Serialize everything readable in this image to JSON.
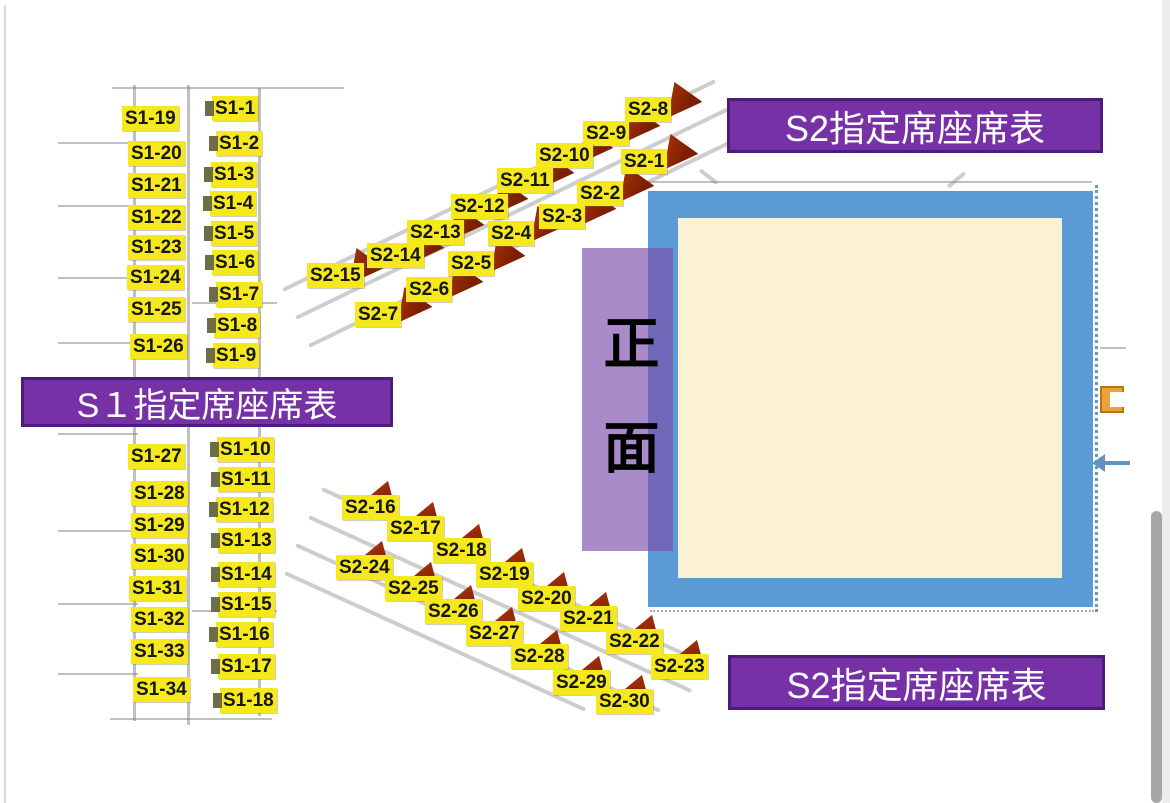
{
  "banners": {
    "s1": {
      "label": "S１指定席座席表"
    },
    "s2_top": {
      "label": "S2指定席座席表"
    },
    "s2_bottom": {
      "label": "S2指定席座席表"
    }
  },
  "stage": {
    "front_label": "正面"
  },
  "colors": {
    "seat_label_bg": "#F5E91E",
    "seat_label_text": "#161616",
    "banner_bg": "#7731A6",
    "banner_border": "#4D1C7A",
    "banner_text": "#FFFFFF",
    "stage_border": "#5B9BD5",
    "stage_fill": "#FBF1D3",
    "front_overlay": "#7B4FAB",
    "seat_marker": "#8A2505"
  },
  "seats": {
    "s1": [
      {
        "t": "S1-19",
        "x": 122,
        "y": 106,
        "z": "l"
      },
      {
        "t": "S1-20",
        "x": 128,
        "y": 141,
        "z": "l"
      },
      {
        "t": "S1-21",
        "x": 128,
        "y": 173,
        "z": "l"
      },
      {
        "t": "S1-22",
        "x": 128,
        "y": 205,
        "z": "l"
      },
      {
        "t": "S1-23",
        "x": 128,
        "y": 235,
        "z": "l"
      },
      {
        "t": "S1-24",
        "x": 127,
        "y": 265,
        "z": "l"
      },
      {
        "t": "S1-25",
        "x": 128,
        "y": 297,
        "z": "l"
      },
      {
        "t": "S1-26",
        "x": 130,
        "y": 334,
        "z": "l"
      },
      {
        "t": "S1-27",
        "x": 128,
        "y": 444,
        "z": "l"
      },
      {
        "t": "S1-28",
        "x": 131,
        "y": 481,
        "z": "l"
      },
      {
        "t": "S1-29",
        "x": 131,
        "y": 513,
        "z": "l"
      },
      {
        "t": "S1-30",
        "x": 131,
        "y": 544,
        "z": "l"
      },
      {
        "t": "S1-31",
        "x": 129,
        "y": 576,
        "z": "l"
      },
      {
        "t": "S1-32",
        "x": 131,
        "y": 607,
        "z": "l"
      },
      {
        "t": "S1-33",
        "x": 131,
        "y": 639,
        "z": "l"
      },
      {
        "t": "S1-34",
        "x": 133,
        "y": 677,
        "z": "l"
      },
      {
        "t": "S1-1",
        "x": 212,
        "y": 96,
        "z": "r"
      },
      {
        "t": "S1-2",
        "x": 216,
        "y": 131,
        "z": "r"
      },
      {
        "t": "S1-3",
        "x": 211,
        "y": 162,
        "z": "r"
      },
      {
        "t": "S1-4",
        "x": 210,
        "y": 191,
        "z": "r"
      },
      {
        "t": "S1-5",
        "x": 211,
        "y": 221,
        "z": "r"
      },
      {
        "t": "S1-6",
        "x": 212,
        "y": 250,
        "z": "r"
      },
      {
        "t": "S1-7",
        "x": 216,
        "y": 282,
        "z": "r"
      },
      {
        "t": "S1-8",
        "x": 214,
        "y": 313,
        "z": "r"
      },
      {
        "t": "S1-9",
        "x": 213,
        "y": 343,
        "z": "r"
      },
      {
        "t": "S1-10",
        "x": 217,
        "y": 437,
        "z": "r"
      },
      {
        "t": "S1-11",
        "x": 218,
        "y": 467,
        "z": "r"
      },
      {
        "t": "S1-12",
        "x": 216,
        "y": 497,
        "z": "r"
      },
      {
        "t": "S1-13",
        "x": 218,
        "y": 528,
        "z": "r"
      },
      {
        "t": "S1-14",
        "x": 218,
        "y": 562,
        "z": "r"
      },
      {
        "t": "S1-15",
        "x": 218,
        "y": 592,
        "z": "r"
      },
      {
        "t": "S1-16",
        "x": 216,
        "y": 622,
        "z": "r"
      },
      {
        "t": "S1-17",
        "x": 218,
        "y": 654,
        "z": "r"
      },
      {
        "t": "S1-18",
        "x": 220,
        "y": 688,
        "z": "r"
      }
    ],
    "s2": [
      {
        "t": "S2-8",
        "x": 625,
        "y": 97,
        "z": "t"
      },
      {
        "t": "S2-9",
        "x": 583,
        "y": 121,
        "z": "t"
      },
      {
        "t": "S2-10",
        "x": 536,
        "y": 143,
        "z": "t"
      },
      {
        "t": "S2-11",
        "x": 497,
        "y": 168,
        "z": "t"
      },
      {
        "t": "S2-12",
        "x": 451,
        "y": 194,
        "z": "t"
      },
      {
        "t": "S2-13",
        "x": 407,
        "y": 220,
        "z": "t"
      },
      {
        "t": "S2-14",
        "x": 367,
        "y": 243,
        "z": "t"
      },
      {
        "t": "S2-15",
        "x": 307,
        "y": 263,
        "z": "t"
      },
      {
        "t": "S2-1",
        "x": 621,
        "y": 149,
        "z": "t"
      },
      {
        "t": "S2-2",
        "x": 577,
        "y": 181,
        "z": "t"
      },
      {
        "t": "S2-3",
        "x": 539,
        "y": 204,
        "z": "t"
      },
      {
        "t": "S2-4",
        "x": 488,
        "y": 221,
        "z": "t"
      },
      {
        "t": "S2-5",
        "x": 448,
        "y": 251,
        "z": "t"
      },
      {
        "t": "S2-6",
        "x": 406,
        "y": 277,
        "z": "t"
      },
      {
        "t": "S2-7",
        "x": 355,
        "y": 302,
        "z": "t"
      },
      {
        "t": "S2-16",
        "x": 342,
        "y": 495,
        "z": "u"
      },
      {
        "t": "S2-17",
        "x": 387,
        "y": 516,
        "z": "u"
      },
      {
        "t": "S2-18",
        "x": 433,
        "y": 538,
        "z": "u"
      },
      {
        "t": "S2-19",
        "x": 476,
        "y": 562,
        "z": "u"
      },
      {
        "t": "S2-20",
        "x": 518,
        "y": 586,
        "z": "u"
      },
      {
        "t": "S2-21",
        "x": 560,
        "y": 606,
        "z": "u"
      },
      {
        "t": "S2-22",
        "x": 606,
        "y": 629,
        "z": "u"
      },
      {
        "t": "S2-23",
        "x": 651,
        "y": 654,
        "z": "u"
      },
      {
        "t": "S2-24",
        "x": 336,
        "y": 555,
        "z": "u"
      },
      {
        "t": "S2-25",
        "x": 385,
        "y": 576,
        "z": "u"
      },
      {
        "t": "S2-26",
        "x": 425,
        "y": 599,
        "z": "u"
      },
      {
        "t": "S2-27",
        "x": 466,
        "y": 621,
        "z": "u"
      },
      {
        "t": "S2-28",
        "x": 511,
        "y": 644,
        "z": "u"
      },
      {
        "t": "S2-29",
        "x": 553,
        "y": 670,
        "z": "u"
      },
      {
        "t": "S2-30",
        "x": 596,
        "y": 689,
        "z": "u"
      }
    ]
  }
}
